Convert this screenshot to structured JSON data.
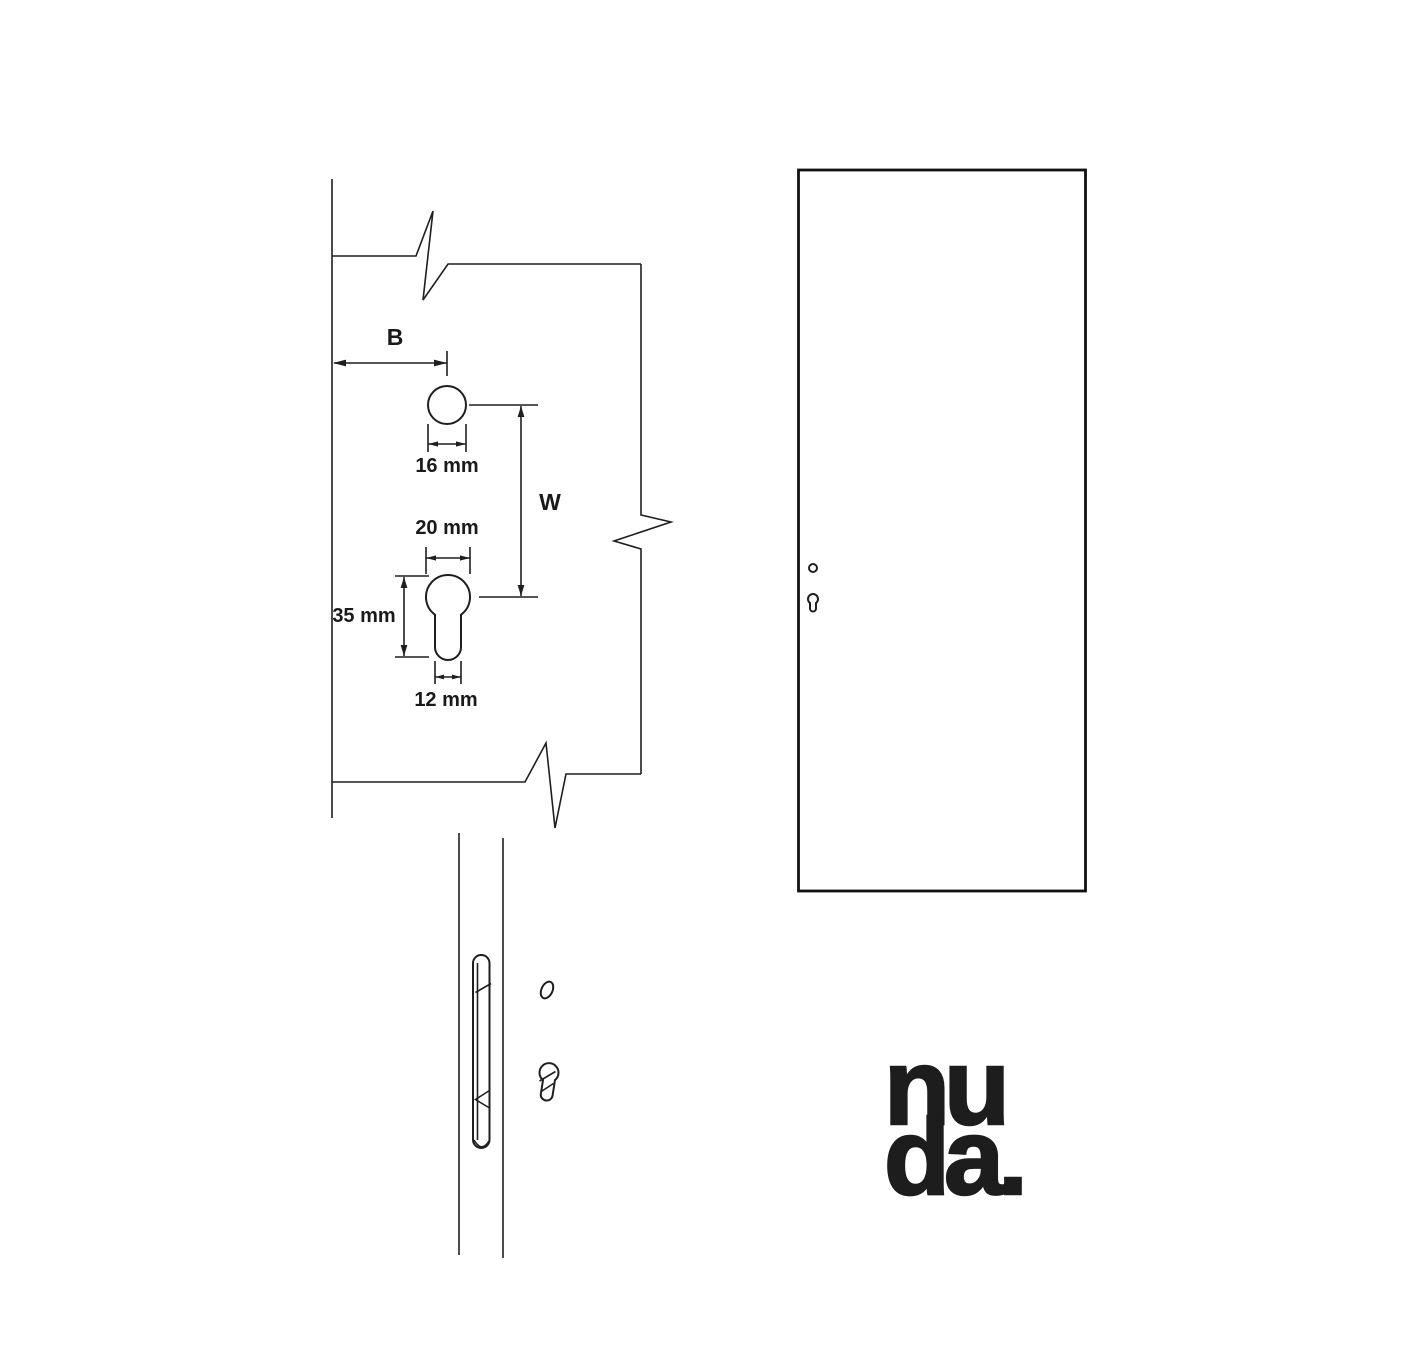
{
  "drawing": {
    "dimension_labels": {
      "backset": "B",
      "vertical_distance": "W",
      "handle_hole_diameter": "16 mm",
      "cylinder_width": "20 mm",
      "cylinder_length": "35 mm",
      "cylinder_stem_width": "12 mm"
    }
  },
  "logo": {
    "line1": "nu",
    "line2": "da."
  },
  "colors": {
    "background": "#ffffff",
    "line": "#1f1f1f",
    "logo": "#1d1d1d"
  }
}
